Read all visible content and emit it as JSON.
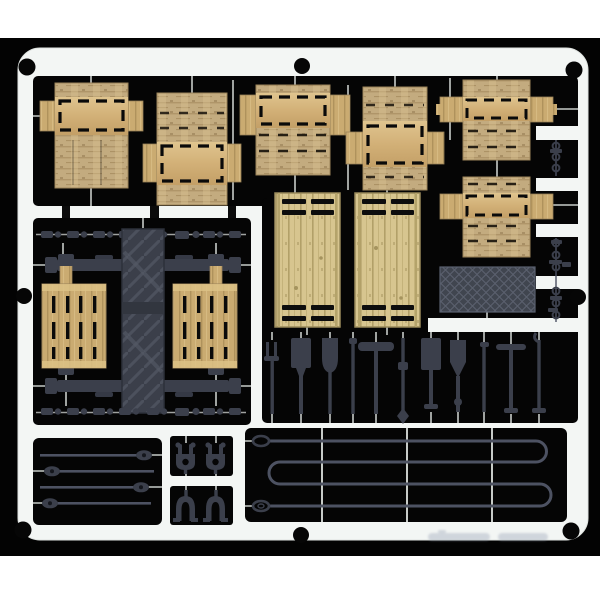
{
  "photo": {
    "subject": "model kit sprue photo",
    "watermark": ""
  },
  "colors": {
    "page_bg": "#ffffff",
    "photo_bg": "#030303",
    "sprue": "#f3f6f4",
    "sprue_edge": "#d9dedb",
    "runner": "#c7cbc8",
    "wood_main": "#c9a96d",
    "wood_light": "#e2c78f",
    "wood_dark": "#a4884f",
    "wood_rough": "#c4ab7d",
    "wood_pale": "#d8c58d",
    "wood_pale_dark": "#b3a066",
    "plastic": "#3b3f4c",
    "plastic_light": "#4d5263",
    "steel": "#40454f",
    "steel_line": "#5b6170",
    "cut_black": "#0a0a0a",
    "watermark_ink": "#8f9ab0"
  },
  "inventory": {
    "crate_flats": 7,
    "wooden_doors": 2,
    "pallets": 2,
    "corner_posts": 2,
    "tarp_bundle": 1,
    "tread_plate_panel": 1,
    "hand_tools": 11,
    "cargo_beams": 2,
    "small_fittings": 16,
    "tie_rods": 4,
    "clevis_clamps": 2,
    "arch_clamps": 2,
    "tow_cable": 1,
    "chain_strips": 2,
    "frame_holes": 8
  }
}
